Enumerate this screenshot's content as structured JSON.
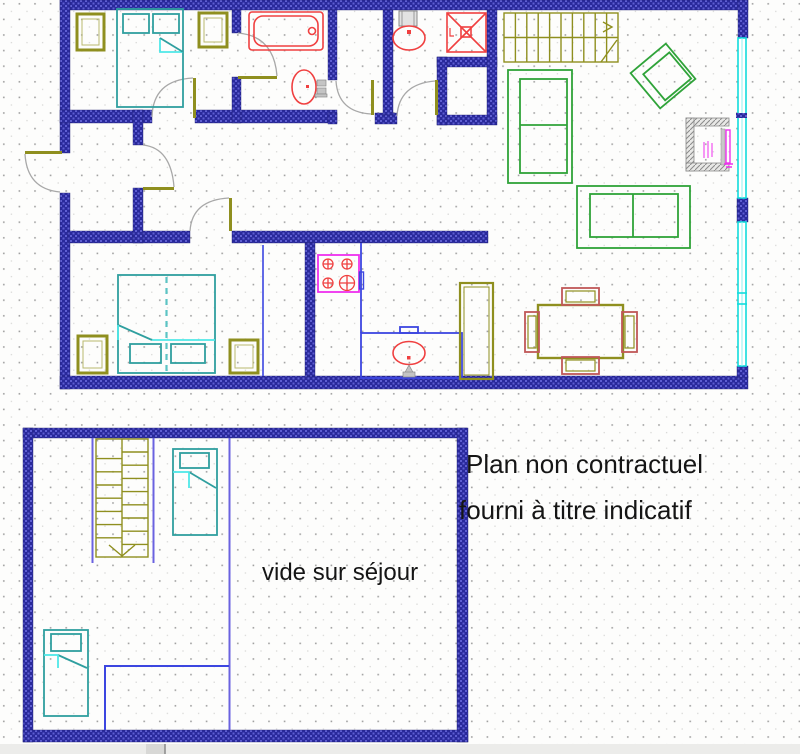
{
  "texts": {
    "void_label": "vide sur séjour",
    "note_line1": "Plan non contractuel",
    "note_line2": "fourni à titre indicatif"
  },
  "colors": {
    "wall": "#29299b",
    "wall_light": "#5e5ed2",
    "olive": "#8f8f1f",
    "fixture_red": "#f04040",
    "bed_teal": "#2f9f9f",
    "bed_fold": "#4fe8e8",
    "sofa_green": "#2fa339",
    "counter_blue": "#3c46e0",
    "rail_violet": "#6a62e0",
    "window_cyan": "#12dcdc",
    "arc_gray": "#a8a8a8",
    "magenta": "#ee30ee",
    "grid_dot": "#a0a0a0",
    "canvas": "#fdfdfc",
    "statusbar_gray": "#ececea"
  }
}
